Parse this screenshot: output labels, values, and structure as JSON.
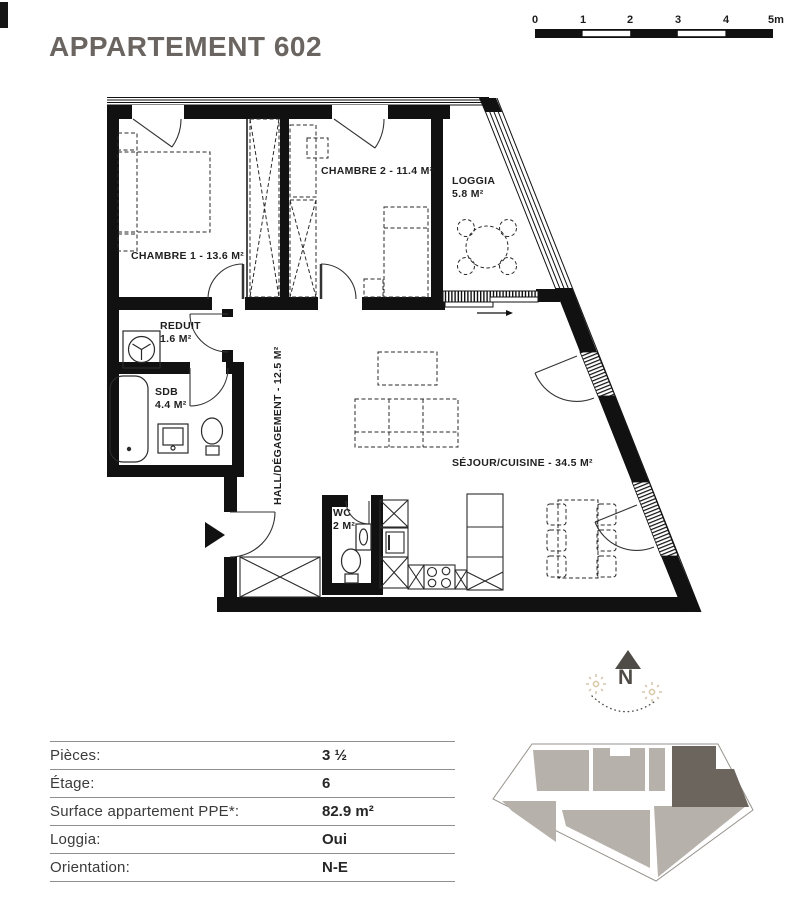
{
  "page": {
    "title": "APPARTEMENT 602"
  },
  "scale_bar": {
    "unit_labels": [
      "0",
      "1",
      "2",
      "3",
      "4",
      "5m"
    ]
  },
  "floor_plan": {
    "rooms": {
      "chambre1": {
        "label": "CHAMBRE 1 - 13.6 M²"
      },
      "chambre2": {
        "label": "CHAMBRE 2 - 11.4 M²"
      },
      "loggia": {
        "name": "LOGGIA",
        "area": "5.8 M²"
      },
      "reduit": {
        "name": "REDUIT",
        "area": "1.6 M²"
      },
      "sdb": {
        "name": "SDB",
        "area": "4.4 M²"
      },
      "wc": {
        "name": "WC",
        "area": "2 M²"
      },
      "hall": {
        "label": "HALL/DÉGAGEMENT - 12.5 M²"
      },
      "sejour": {
        "label": "SÉJOUR/CUISINE - 34.5 M²"
      }
    },
    "compass": {
      "north_label": "N"
    }
  },
  "details_table": {
    "rows": [
      {
        "label": "Pièces:",
        "value": "3 ½"
      },
      {
        "label": "Étage:",
        "value": "6"
      },
      {
        "label": "Surface appartement PPE*:",
        "value": "82.9 m²"
      },
      {
        "label": "Loggia:",
        "value": "Oui"
      },
      {
        "label": "Orientation:",
        "value": "N-E"
      }
    ]
  },
  "colors": {
    "title": "#6a6560",
    "walls": "#111111",
    "compass": "#4f4b46",
    "sun_accent": "#d8cab0",
    "keymap_unit": "#b6b1ab",
    "keymap_highlight": "#6b655e"
  }
}
